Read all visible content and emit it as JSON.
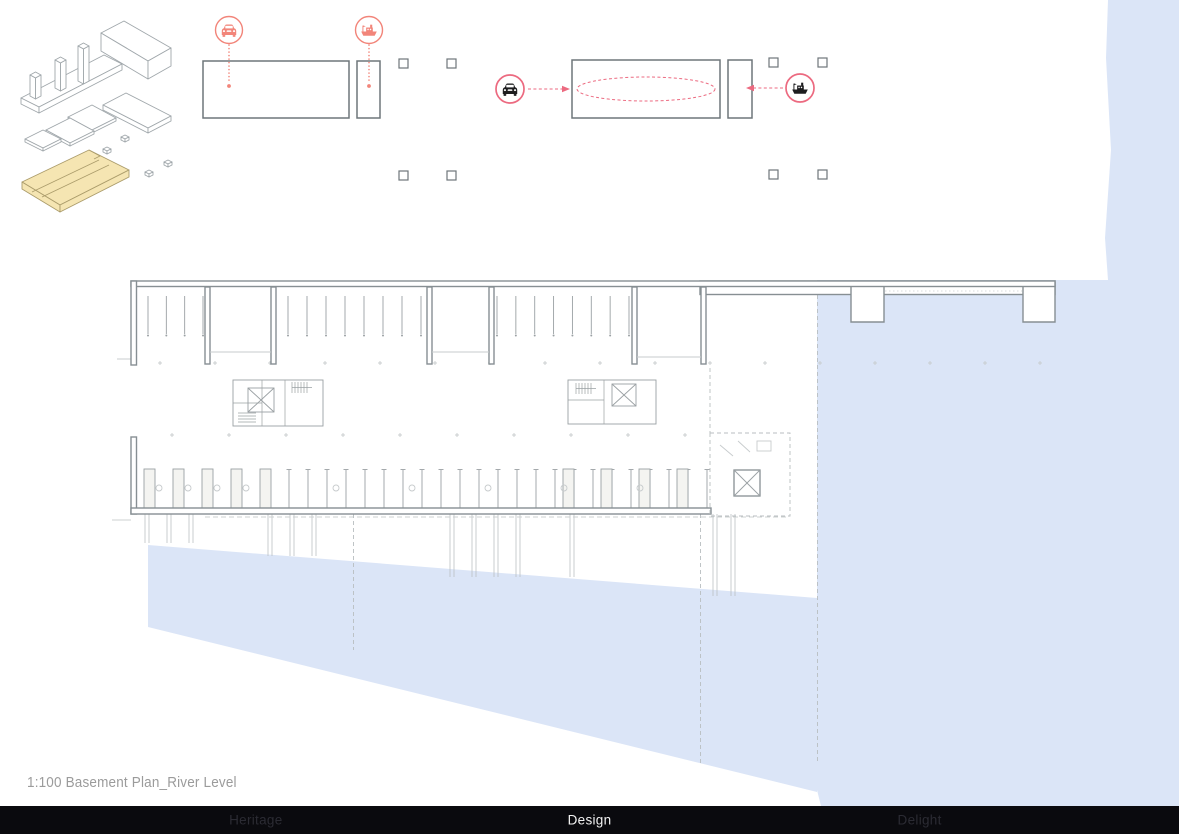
{
  "caption": {
    "text": "1:100 Basement Plan_River Level"
  },
  "navbar": {
    "items": [
      {
        "label": "Heritage",
        "active": false
      },
      {
        "label": "Design",
        "active": true
      },
      {
        "label": "Delight",
        "active": false
      }
    ]
  },
  "diagrams": {
    "vehicle_icons": [
      "car-icon",
      "boat-icon"
    ],
    "iso_highlight": "basement-river-level-slab"
  },
  "colors": {
    "water": "#dbe5f7",
    "salmon": "#f2857a",
    "pink": "#ec6a80",
    "plan_line": "#878f93",
    "thin_line": "#9aa0a3",
    "faint_line": "#c7cbcd",
    "highlight": "#f5e5b2",
    "highlight_edge": "#ab9c6b",
    "box_line": "#6e767a",
    "nav_bg": "#0a0a0e",
    "nav_dim": "#2b2b33",
    "nav_active": "#f2f2f2",
    "caption_color": "#9b9b9b"
  }
}
